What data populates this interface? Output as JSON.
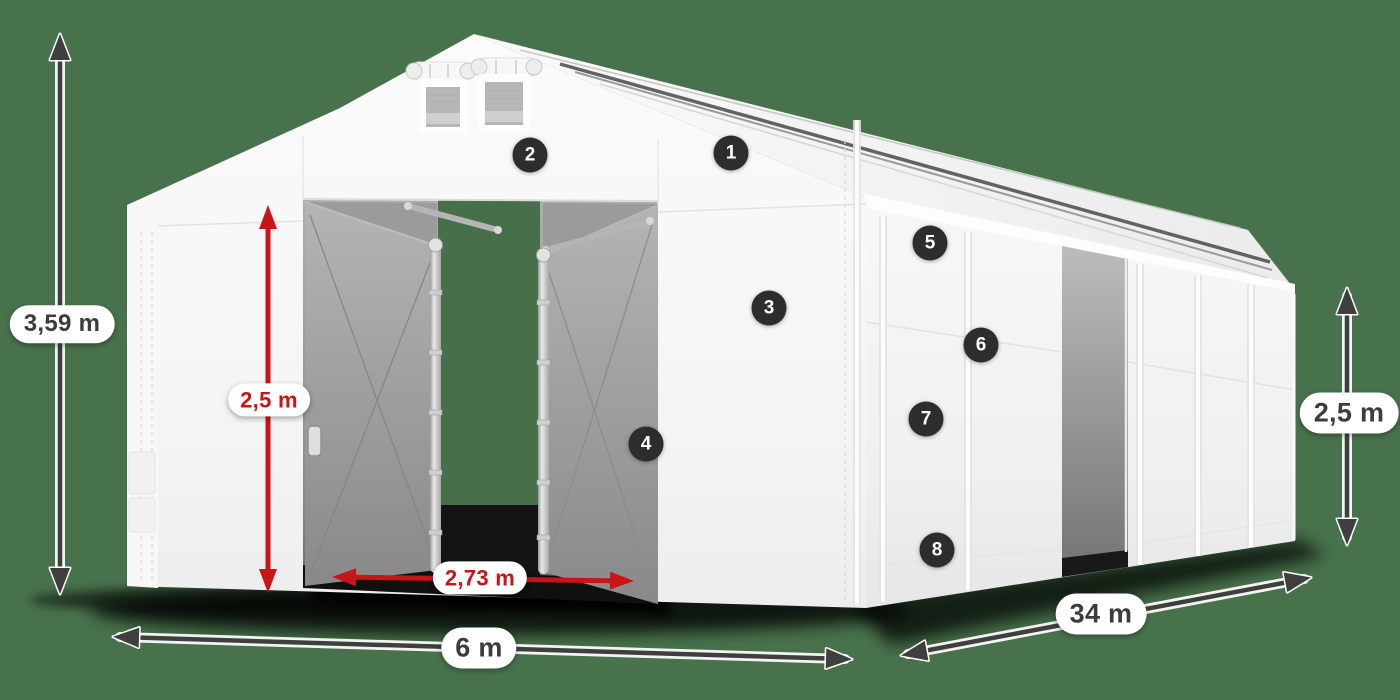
{
  "colors": {
    "background": "#48724c",
    "dimension_red": "#c91418",
    "dimension_dark": "#3f3f3f",
    "badge_background": "#2d2d2d",
    "badge_text": "#ffffff",
    "label_background": "#ffffff",
    "label_text_dark": "#3c3c3c",
    "tent_white": "#f5f5f5"
  },
  "dimension_labels": {
    "total_height": "3,59 m",
    "entrance_height": "2,5 m",
    "entrance_width": "2,73 m",
    "tent_width": "6 m",
    "tent_length": "34 m",
    "side_height": "2,5 m"
  },
  "feature_markers": [
    {
      "number": "1"
    },
    {
      "number": "2"
    },
    {
      "number": "3"
    },
    {
      "number": "4"
    },
    {
      "number": "5"
    },
    {
      "number": "6"
    },
    {
      "number": "7"
    },
    {
      "number": "8"
    }
  ]
}
